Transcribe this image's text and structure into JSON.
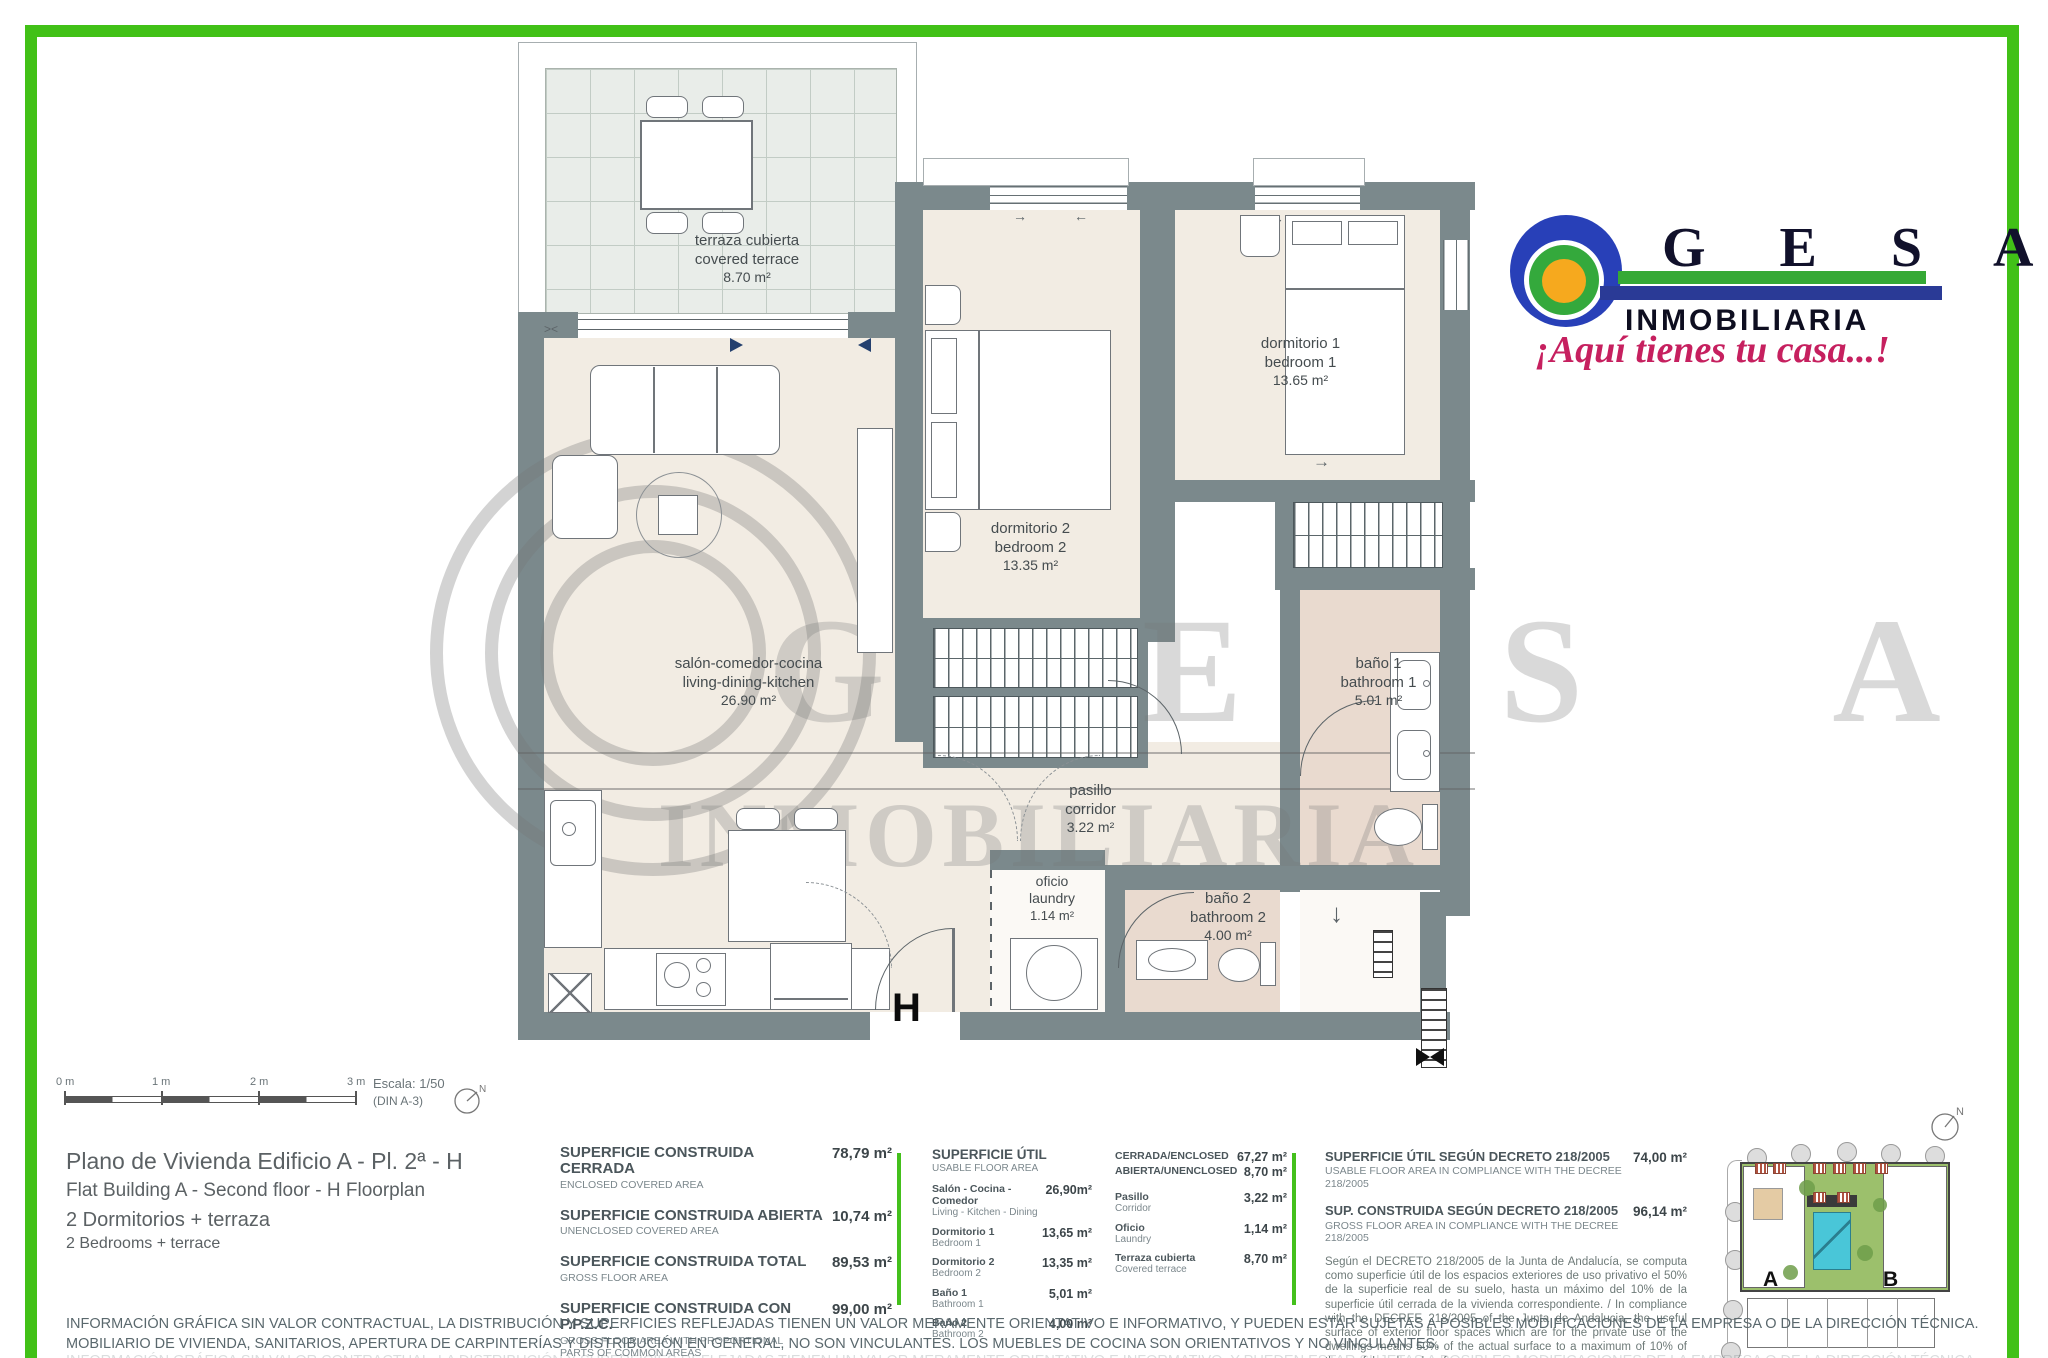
{
  "logo": {
    "letters": "G E S A",
    "subtitle": "INMOBILIARIA",
    "tagline": "¡Aquí tienes tu casa...!",
    "colors": {
      "ball_blue": "#2840b8",
      "ring_green": "#34a93c",
      "center_orange": "#f6a91e",
      "bar_green": "#35a935",
      "bar_blue": "#2a3a96",
      "tagline_pink": "#c6205f"
    }
  },
  "plan": {
    "entrance_label": "H",
    "watermark": {
      "brand": "G E S A",
      "sub": "INMOBILIARIA"
    },
    "rooms": {
      "terrace": {
        "es": "terraza cubierta",
        "en": "covered terrace",
        "area": "8.70 m²"
      },
      "living": {
        "es": "salón-comedor-cocina",
        "en": "living-dining-kitchen",
        "area": "26.90 m²"
      },
      "bedroom2": {
        "es": "dormitorio 2",
        "en": "bedroom 2",
        "area": "13.35 m²"
      },
      "bedroom1": {
        "es": "dormitorio 1",
        "en": "bedroom 1",
        "area": "13.65 m²"
      },
      "bath1": {
        "es": "baño 1",
        "en": "bathroom 1",
        "area": "5.01 m²"
      },
      "bath2": {
        "es": "baño 2",
        "en": "bathroom 2",
        "area": "4.00 m²"
      },
      "corridor": {
        "es": "pasillo",
        "en": "corridor",
        "area": "3.22 m²"
      },
      "laundry": {
        "es": "oficio",
        "en": "laundry",
        "area": "1.14 m²"
      }
    }
  },
  "scale": {
    "ticks": [
      "0 m",
      "1 m",
      "2 m",
      "3 m"
    ],
    "escala": "Escala: 1/50",
    "din": "(DIN A-3)",
    "north": "N"
  },
  "title": {
    "line1": "Plano de Vivienda Edificio A - Pl. 2ª - H",
    "line2": "Flat Building A - Second floor - H  Floorplan",
    "line3": "2 Dormitorios + terraza",
    "line4": "2 Bedrooms + terrace"
  },
  "areas": {
    "built": [
      {
        "es": "SUPERFICIE CONSTRUIDA CERRADA",
        "en": "ENCLOSED COVERED AREA",
        "value": "78,79 m²"
      },
      {
        "es": "SUPERFICIE CONSTRUIDA ABIERTA",
        "en": "UNENCLOSED COVERED AREA",
        "value": "10,74 m²"
      },
      {
        "es": "SUPERFICIE CONSTRUIDA TOTAL",
        "en": "GROSS FLOOR AREA",
        "value": "89,53 m²"
      },
      {
        "es": "SUPERFICIE CONSTRUIDA CON P.P.Z.C.",
        "en": "GROSS FLOOR AREA WITH PROPORTIONAL PARTS OF COMMON AREAS",
        "value": "99,00 m²"
      }
    ],
    "usable": {
      "header_es": "SUPERFICIE ÚTIL",
      "header_en": "USABLE FLOOR AREA",
      "rows": [
        {
          "es": "Salón - Cocina - Comedor",
          "en": "Living - Kitchen - Dining",
          "value": "26,90m²"
        },
        {
          "es": "Dormitorio 1",
          "en": "Bedroom 1",
          "value": "13,65 m²"
        },
        {
          "es": "Dormitorio 2",
          "en": "Bedroom 2",
          "value": "13,35 m²"
        },
        {
          "es": "Baño 1",
          "en": "Bathroom 1",
          "value": "5,01 m²"
        },
        {
          "es": "Baño 2",
          "en": "Bathroom 2",
          "value": "4,00 m²"
        }
      ]
    },
    "enclosed": {
      "head": [
        {
          "label": "CERRADA/ENCLOSED",
          "value": "67,27 m²"
        },
        {
          "label": "ABIERTA/UNENCLOSED",
          "value": "8,70 m²"
        }
      ],
      "rows": [
        {
          "es": "Pasillo",
          "en": "Corridor",
          "value": "3,22 m²"
        },
        {
          "es": "Oficio",
          "en": "Laundry",
          "value": "1,14 m²"
        },
        {
          "es": "Terraza cubierta",
          "en": "Covered terrace",
          "value": "8,70 m²"
        }
      ]
    },
    "decree": {
      "rows": [
        {
          "es": "SUPERFICIE ÚTIL SEGÚN DECRETO 218/2005",
          "en": "USABLE FLOOR AREA IN COMPLIANCE WITH THE DECREE 218/2005",
          "value": "74,00 m²"
        },
        {
          "es": "SUP. CONSTRUIDA SEGÚN DECRETO 218/2005",
          "en": "GROSS FLOOR AREA IN COMPLIANCE WITH THE DECREE 218/2005",
          "value": "96,14 m²"
        }
      ],
      "note": "Según el DECRETO 218/2005 de la Junta de Andalucía, se computa como superficie útil de los espacios exteriores de uso privativo el 50% de la superficie real de su suelo, hasta un máximo del 10% de la superficie útil cerrada de la vivienda correspondiente. / In compliance with the DECREE 218/2005 of the Junta de Andalucia, the useful surface of exterior floor spaces which are for the private use of the dwellings means 50% of the actual surface to a maximum of 10% of the useful enclosed surface."
    }
  },
  "siteplan": {
    "a": "A",
    "b": "B",
    "north": "N"
  },
  "disclaimer": {
    "line1": "INFORMACIÓN GRÁFICA SIN VALOR CONTRACTUAL, LA DISTRIBUCIÓN Y SUPERFICIES REFLEJADAS TIENEN UN VALOR MERAMENTE ORIENTATIVO E INFORMATIVO, Y PUEDEN ESTAR SUJETAS A POSIBLES MODIFICACIONES DE LA EMPRESA O DE LA DIRECCIÓN TÉCNICA.",
    "line2": "MOBILIARIO DE VIVIENDA, SANITARIOS, APERTURA DE CARPINTERÍAS Y DISTRIBUCIÓN EN GENERAL, NO SON VINCULANTES. LOS MUEBLES DE COCINA SON ORIENTATIVOS Y NO VINCULANTES."
  }
}
